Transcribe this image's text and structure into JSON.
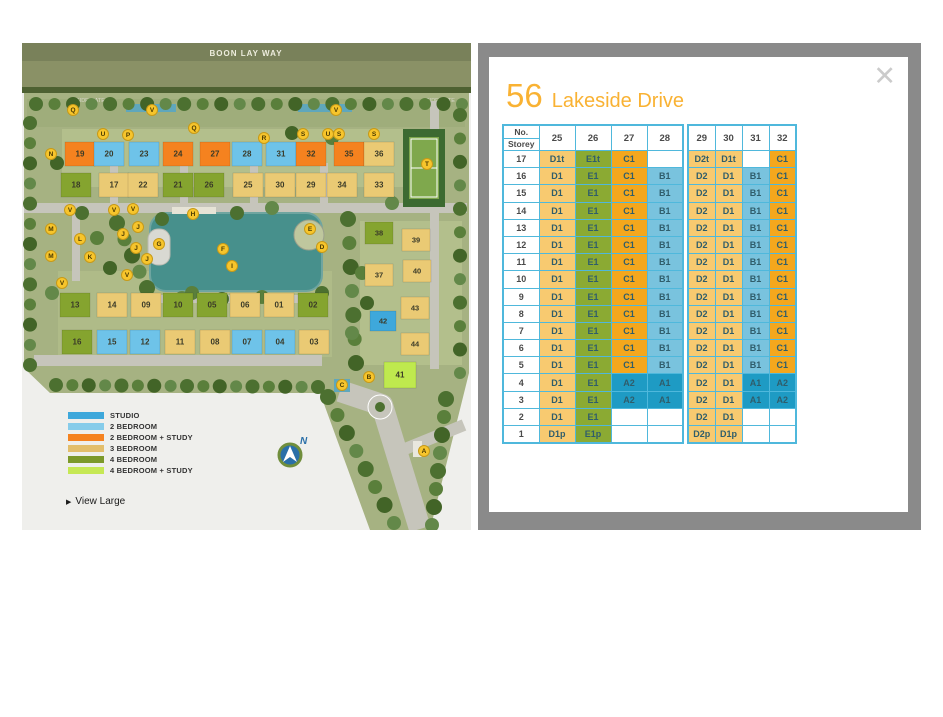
{
  "panel": {
    "bg": "#8A8A8A",
    "close_label": "✕",
    "title": {
      "number": "56",
      "name": "Lakeside Drive",
      "color": "#F9B233"
    },
    "table": {
      "border_color": "#4FB8DC",
      "corner_top": "No.",
      "corner_bottom": "Storey",
      "cell_text_color": "#2F5D6B",
      "type_colors": {
        "A": "#1E9BC4",
        "B": "#79C3DE",
        "C": "#F4A71D",
        "D": "#F8CA70",
        "E": "#8BAA33",
        "": "#FFFFFF"
      },
      "storeys": [
        "17",
        "16",
        "15",
        "14",
        "13",
        "12",
        "11",
        "10",
        "9",
        "8",
        "7",
        "6",
        "5",
        "4",
        "3",
        "2",
        "1"
      ],
      "blocks": [
        {
          "columns": [
            "25",
            "26",
            "27",
            "28"
          ],
          "rows": [
            [
              "D1t",
              "E1t",
              "C1",
              ""
            ],
            [
              "D1",
              "E1",
              "C1",
              "B1"
            ],
            [
              "D1",
              "E1",
              "C1",
              "B1"
            ],
            [
              "D1",
              "E1",
              "C1",
              "B1"
            ],
            [
              "D1",
              "E1",
              "C1",
              "B1"
            ],
            [
              "D1",
              "E1",
              "C1",
              "B1"
            ],
            [
              "D1",
              "E1",
              "C1",
              "B1"
            ],
            [
              "D1",
              "E1",
              "C1",
              "B1"
            ],
            [
              "D1",
              "E1",
              "C1",
              "B1"
            ],
            [
              "D1",
              "E1",
              "C1",
              "B1"
            ],
            [
              "D1",
              "E1",
              "C1",
              "B1"
            ],
            [
              "D1",
              "E1",
              "C1",
              "B1"
            ],
            [
              "D1",
              "E1",
              "C1",
              "B1"
            ],
            [
              "D1",
              "E1",
              "A2",
              "A1"
            ],
            [
              "D1",
              "E1",
              "A2",
              "A1"
            ],
            [
              "D1",
              "E1",
              "",
              ""
            ],
            [
              "D1p",
              "E1p",
              "",
              ""
            ]
          ]
        },
        {
          "columns": [
            "29",
            "30",
            "31",
            "32"
          ],
          "rows": [
            [
              "D2t",
              "D1t",
              "",
              "C1"
            ],
            [
              "D2",
              "D1",
              "B1",
              "C1"
            ],
            [
              "D2",
              "D1",
              "B1",
              "C1"
            ],
            [
              "D2",
              "D1",
              "B1",
              "C1"
            ],
            [
              "D2",
              "D1",
              "B1",
              "C1"
            ],
            [
              "D2",
              "D1",
              "B1",
              "C1"
            ],
            [
              "D2",
              "D1",
              "B1",
              "C1"
            ],
            [
              "D2",
              "D1",
              "B1",
              "C1"
            ],
            [
              "D2",
              "D1",
              "B1",
              "C1"
            ],
            [
              "D2",
              "D1",
              "B1",
              "C1"
            ],
            [
              "D2",
              "D1",
              "B1",
              "C1"
            ],
            [
              "D2",
              "D1",
              "B1",
              "C1"
            ],
            [
              "D2",
              "D1",
              "B1",
              "C1"
            ],
            [
              "D2",
              "D1",
              "A1",
              "A2"
            ],
            [
              "D2",
              "D1",
              "A1",
              "A2"
            ],
            [
              "D2",
              "D1",
              "",
              ""
            ],
            [
              "D2p",
              "D1p",
              "",
              ""
            ]
          ]
        }
      ]
    }
  },
  "map": {
    "bg": "#EFEFEC",
    "site_color": "#A6B282",
    "road_band": {
      "label": "BOON LAY WAY",
      "band1": "#79815A",
      "band2": "#8A9166",
      "hedge": "#4E6132",
      "text_color": "#EDEDDD"
    },
    "side_gates": [
      {
        "label": "SIDE GATE",
        "x": 54,
        "y": 59
      },
      {
        "label": "SIDE GATE",
        "x": 404,
        "y": 59
      }
    ],
    "roads_color": "#C6C5BB",
    "pool_color": "#5FA7BC",
    "building_text": "#3A3A28",
    "type_colors": {
      "studio": "#3EA8DB",
      "b2": "#6EC3E9",
      "b2s": "#F5821F",
      "b3": "#EACA74",
      "b4": "#85A42F",
      "b4s": "#BFE94E"
    },
    "lake": {
      "x": 128,
      "y": 170,
      "w": 172,
      "h": 78,
      "color": "#47908C",
      "edge": "#6FA5A0"
    },
    "court": {
      "x": 381,
      "y": 86,
      "w": 42,
      "h": 78,
      "outer": "#3C6A31",
      "inner": "#7FA84D"
    },
    "patches": [
      {
        "x": 5,
        "y": 56,
        "w": 438,
        "h": 28,
        "c": "#9FAD7B"
      },
      {
        "x": 40,
        "y": 86,
        "w": 380,
        "h": 58,
        "c": "#B3BF8C"
      },
      {
        "x": 36,
        "y": 228,
        "w": 274,
        "h": 86,
        "c": "#AFBB88"
      },
      {
        "x": 338,
        "y": 178,
        "w": 102,
        "h": 144,
        "c": "#B3BF8C"
      }
    ],
    "roads": [
      {
        "x": 2,
        "y": 160,
        "w": 443,
        "h": 10
      },
      {
        "x": 12,
        "y": 312,
        "w": 288,
        "h": 11
      },
      {
        "x": 50,
        "y": 170,
        "w": 8,
        "h": 68
      },
      {
        "x": 408,
        "y": 58,
        "w": 9,
        "h": 268
      },
      {
        "x": 88,
        "y": 120,
        "w": 8,
        "h": 42
      },
      {
        "x": 158,
        "y": 120,
        "w": 8,
        "h": 42
      },
      {
        "x": 228,
        "y": 120,
        "w": 8,
        "h": 42
      },
      {
        "x": 298,
        "y": 120,
        "w": 8,
        "h": 42
      },
      {
        "x": 122,
        "y": 252,
        "w": 180,
        "h": 8
      }
    ],
    "pools": [
      {
        "x": 104,
        "y": 61,
        "w": 50,
        "h": 8
      },
      {
        "x": 276,
        "y": 61,
        "w": 54,
        "h": 8
      },
      {
        "x": 312,
        "y": 336,
        "w": 16,
        "h": 13
      }
    ],
    "tree_palette": [
      "#4C7030",
      "#5A7F3B",
      "#426427",
      "#638849"
    ],
    "tree_lines": [
      {
        "x1": 14,
        "y1": 61,
        "x2": 440,
        "y2": 61,
        "n": 24,
        "r": 7
      },
      {
        "x1": 8,
        "y1": 80,
        "x2": 8,
        "y2": 322,
        "n": 13,
        "r": 7
      },
      {
        "x1": 34,
        "y1": 342,
        "x2": 296,
        "y2": 344,
        "n": 17,
        "r": 7
      },
      {
        "x1": 306,
        "y1": 354,
        "x2": 372,
        "y2": 480,
        "n": 8,
        "r": 8
      },
      {
        "x1": 424,
        "y1": 356,
        "x2": 410,
        "y2": 482,
        "n": 8,
        "r": 8
      },
      {
        "x1": 438,
        "y1": 72,
        "x2": 438,
        "y2": 330,
        "n": 12,
        "r": 7
      },
      {
        "x1": 326,
        "y1": 176,
        "x2": 334,
        "y2": 320,
        "n": 7,
        "r": 8
      },
      {
        "x1": 95,
        "y1": 180,
        "x2": 125,
        "y2": 245,
        "n": 5,
        "r": 8
      }
    ],
    "tree_scatter": [
      [
        60,
        170
      ],
      [
        75,
        195
      ],
      [
        88,
        225
      ],
      [
        250,
        165
      ],
      [
        215,
        170
      ],
      [
        310,
        95
      ],
      [
        270,
        90
      ],
      [
        160,
        255
      ],
      [
        200,
        256
      ],
      [
        240,
        254
      ],
      [
        350,
        140
      ],
      [
        370,
        160
      ],
      [
        300,
        250
      ],
      [
        340,
        230
      ],
      [
        345,
        260
      ],
      [
        330,
        290
      ],
      [
        140,
        176
      ],
      [
        170,
        250
      ],
      [
        35,
        120
      ],
      [
        30,
        250
      ]
    ],
    "buildings": [
      {
        "n": "19",
        "x": 58,
        "y": 111,
        "t": "b2s"
      },
      {
        "n": "20",
        "x": 87,
        "y": 111,
        "t": "b2"
      },
      {
        "n": "23",
        "x": 122,
        "y": 111,
        "t": "b2"
      },
      {
        "n": "24",
        "x": 156,
        "y": 111,
        "t": "b2s"
      },
      {
        "n": "27",
        "x": 193,
        "y": 111,
        "t": "b2s"
      },
      {
        "n": "28",
        "x": 225,
        "y": 111,
        "t": "b2"
      },
      {
        "n": "31",
        "x": 259,
        "y": 111,
        "t": "b2"
      },
      {
        "n": "32",
        "x": 289,
        "y": 111,
        "t": "b2s"
      },
      {
        "n": "35",
        "x": 327,
        "y": 111,
        "t": "b2s"
      },
      {
        "n": "36",
        "x": 357,
        "y": 111,
        "t": "b3"
      },
      {
        "n": "18",
        "x": 54,
        "y": 142,
        "t": "b4"
      },
      {
        "n": "17",
        "x": 92,
        "y": 142,
        "t": "b3"
      },
      {
        "n": "22",
        "x": 121,
        "y": 142,
        "t": "b3"
      },
      {
        "n": "21",
        "x": 156,
        "y": 142,
        "t": "b4"
      },
      {
        "n": "26",
        "x": 187,
        "y": 142,
        "t": "b4"
      },
      {
        "n": "25",
        "x": 226,
        "y": 142,
        "t": "b3"
      },
      {
        "n": "30",
        "x": 258,
        "y": 142,
        "t": "b3"
      },
      {
        "n": "29",
        "x": 289,
        "y": 142,
        "t": "b3"
      },
      {
        "n": "34",
        "x": 320,
        "y": 142,
        "t": "b3"
      },
      {
        "n": "33",
        "x": 357,
        "y": 142,
        "t": "b3"
      },
      {
        "n": "13",
        "x": 53,
        "y": 262,
        "t": "b4"
      },
      {
        "n": "14",
        "x": 90,
        "y": 262,
        "t": "b3"
      },
      {
        "n": "09",
        "x": 124,
        "y": 262,
        "t": "b3"
      },
      {
        "n": "10",
        "x": 156,
        "y": 262,
        "t": "b4"
      },
      {
        "n": "05",
        "x": 190,
        "y": 262,
        "t": "b4"
      },
      {
        "n": "06",
        "x": 223,
        "y": 262,
        "t": "b3"
      },
      {
        "n": "01",
        "x": 257,
        "y": 262,
        "t": "b3"
      },
      {
        "n": "02",
        "x": 291,
        "y": 262,
        "t": "b4"
      },
      {
        "n": "16",
        "x": 55,
        "y": 299,
        "t": "b4"
      },
      {
        "n": "15",
        "x": 90,
        "y": 299,
        "t": "b2"
      },
      {
        "n": "12",
        "x": 123,
        "y": 299,
        "t": "b2"
      },
      {
        "n": "11",
        "x": 158,
        "y": 299,
        "t": "b3"
      },
      {
        "n": "08",
        "x": 193,
        "y": 299,
        "t": "b3"
      },
      {
        "n": "07",
        "x": 225,
        "y": 299,
        "t": "b2"
      },
      {
        "n": "04",
        "x": 258,
        "y": 299,
        "t": "b2"
      },
      {
        "n": "03",
        "x": 292,
        "y": 299,
        "t": "b3"
      },
      {
        "n": "38",
        "x": 357,
        "y": 190,
        "t": "b4",
        "w": 28,
        "h": 22
      },
      {
        "n": "39",
        "x": 394,
        "y": 197,
        "t": "b3",
        "w": 28,
        "h": 22
      },
      {
        "n": "37",
        "x": 357,
        "y": 232,
        "t": "b3",
        "w": 28,
        "h": 22
      },
      {
        "n": "40",
        "x": 395,
        "y": 228,
        "t": "b3",
        "w": 28,
        "h": 22
      },
      {
        "n": "43",
        "x": 393,
        "y": 265,
        "t": "b3",
        "w": 28,
        "h": 22
      },
      {
        "n": "42",
        "x": 361,
        "y": 278,
        "t": "studio",
        "w": 26,
        "h": 20
      },
      {
        "n": "44",
        "x": 393,
        "y": 301,
        "t": "b3",
        "w": 28,
        "h": 22
      },
      {
        "n": "41",
        "x": 378,
        "y": 332,
        "t": "b4s",
        "w": 32,
        "h": 26
      }
    ],
    "marker_style": {
      "fill": "#F7C52C",
      "stroke": "#C79A18",
      "text": "#4A3A00"
    },
    "markers": [
      [
        "Q",
        51,
        67
      ],
      [
        "V",
        130,
        67
      ],
      [
        "V",
        314,
        67
      ],
      [
        "U",
        81,
        91
      ],
      [
        "P",
        106,
        92
      ],
      [
        "Q",
        172,
        85
      ],
      [
        "R",
        242,
        95
      ],
      [
        "S",
        281,
        91
      ],
      [
        "U",
        306,
        91
      ],
      [
        "S",
        317,
        91
      ],
      [
        "S",
        352,
        91
      ],
      [
        "N",
        29,
        111
      ],
      [
        "V",
        48,
        167
      ],
      [
        "V",
        92,
        167
      ],
      [
        "V",
        111,
        166
      ],
      [
        "M",
        29,
        186
      ],
      [
        "L",
        58,
        196
      ],
      [
        "M",
        29,
        213
      ],
      [
        "K",
        68,
        214
      ],
      [
        "J",
        101,
        191
      ],
      [
        "J",
        116,
        184
      ],
      [
        "J",
        114,
        205
      ],
      [
        "J",
        125,
        216
      ],
      [
        "V",
        105,
        232
      ],
      [
        "V",
        40,
        240
      ],
      [
        "G",
        137,
        201
      ],
      [
        "H",
        171,
        171
      ],
      [
        "F",
        201,
        206
      ],
      [
        "I",
        210,
        223
      ],
      [
        "E",
        288,
        186
      ],
      [
        "D",
        300,
        204
      ],
      [
        "T",
        405,
        121
      ],
      [
        "C",
        320,
        342
      ],
      [
        "B",
        347,
        334
      ],
      [
        "A",
        402,
        408
      ]
    ],
    "legend": [
      {
        "label": "STUDIO",
        "color": "#3EA8DB"
      },
      {
        "label": "2 BEDROOM",
        "color": "#86CCEA"
      },
      {
        "label": "2 BEDROOM + STUDY",
        "color": "#F5821F"
      },
      {
        "label": "3 BEDROOM",
        "color": "#E3BE6B"
      },
      {
        "label": "4 BEDROOM",
        "color": "#7C992A"
      },
      {
        "label": "4 BEDROOM + STUDY",
        "color": "#C6E854"
      }
    ],
    "view_large_label": "View Large",
    "compass": {
      "label": "N",
      "x": 268,
      "y": 412
    }
  }
}
